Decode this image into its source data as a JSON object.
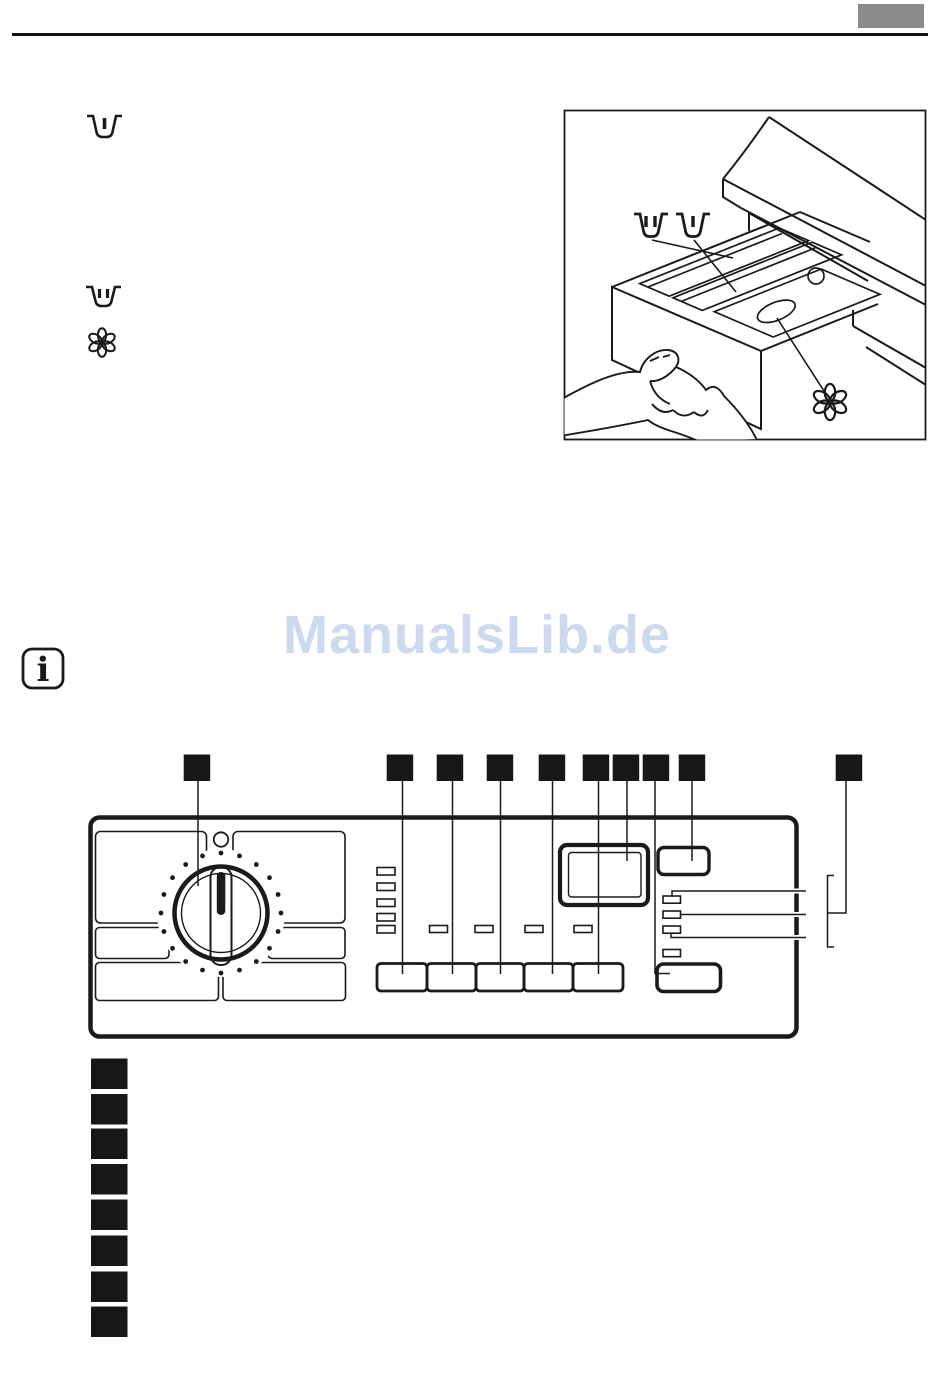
{
  "page": {
    "background": "#ffffff",
    "header": {
      "page_number_box_color": "#8b8b8b"
    },
    "watermark": {
      "text": "ManualsLib.de",
      "color": "#cdd9ee"
    }
  },
  "icons": {
    "margin": [
      {
        "name": "prewash-compartment-icon",
        "glyph": "tub-with-one-bar"
      },
      {
        "name": "main-wash-compartment-icon",
        "glyph": "tub-with-two-bars"
      },
      {
        "name": "softener-compartment-icon",
        "glyph": "six-petal-flower"
      }
    ],
    "note": {
      "name": "info-icon",
      "glyph": "i"
    },
    "figure_symbols": [
      {
        "name": "main-wash-symbol",
        "glyph": "tub-with-two-bars"
      },
      {
        "name": "prewash-symbol",
        "glyph": "tub-with-one-bar"
      },
      {
        "name": "softener-symbol",
        "glyph": "six-petal-flower"
      }
    ]
  },
  "figures": {
    "drawer_illustration": {
      "content": "hand pulling out detergent drawer"
    },
    "control_panel": {
      "callout_marker_count": 10,
      "list_marker_count": 8
    }
  }
}
